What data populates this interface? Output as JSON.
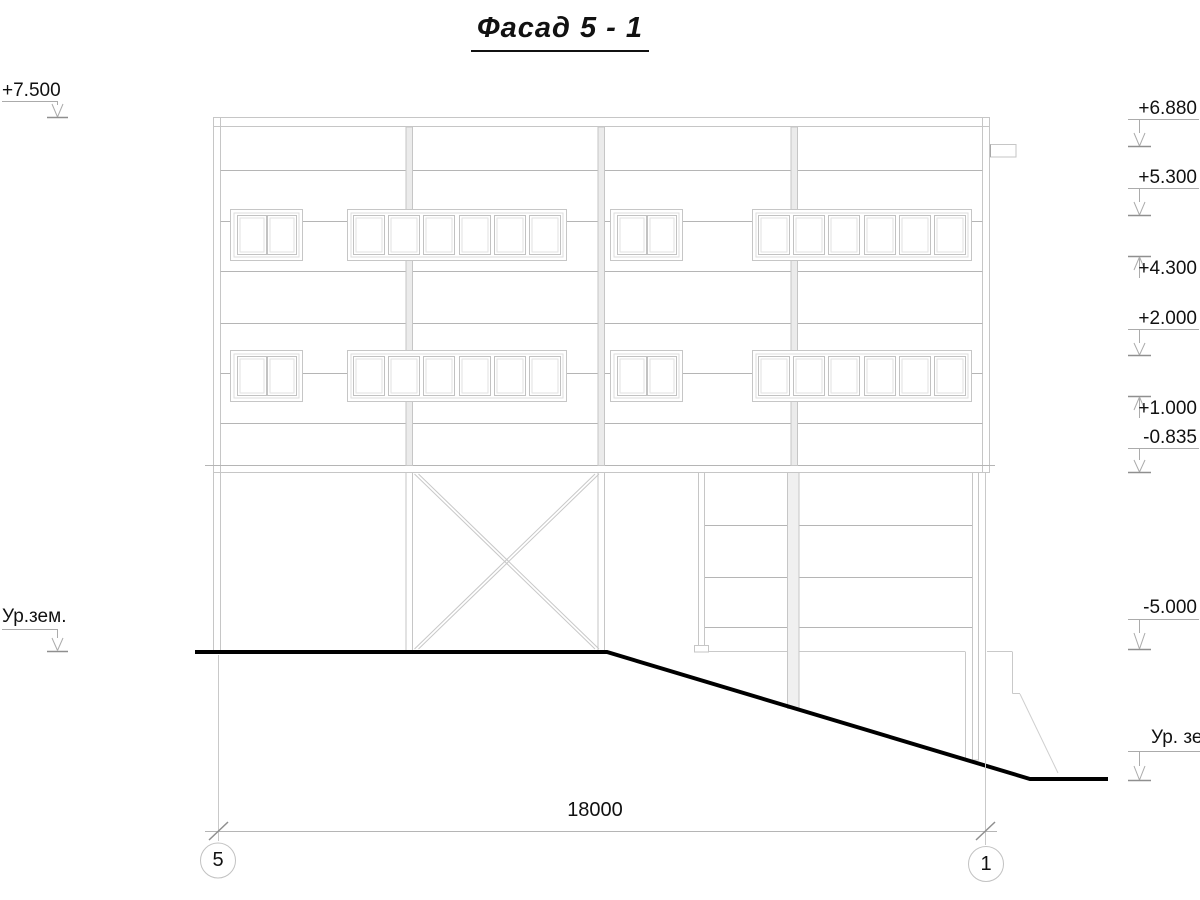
{
  "title": "Фасад 5 - 1",
  "colors": {
    "line_light": "#c6c6c6",
    "line_mid": "#b5b5b5",
    "marker_line": "#ababab",
    "marker_tick": "#8f8f8f",
    "ground_line": "#000000",
    "text": "#111111"
  },
  "left_markers": [
    {
      "label": "+7.500"
    },
    {
      "label": "Ур.зем."
    }
  ],
  "right_markers": [
    {
      "label": "+6.880"
    },
    {
      "label": "+5.300"
    },
    {
      "label": "+4.300"
    },
    {
      "label": "+2.000"
    },
    {
      "label": "+1.000"
    },
    {
      "label": "-0.835"
    },
    {
      "label": "-5.000"
    },
    {
      "label": "Ур. зе"
    }
  ],
  "dimension": {
    "value": "18000"
  },
  "grid_bubbles": [
    {
      "label": "5"
    },
    {
      "label": "1"
    }
  ]
}
